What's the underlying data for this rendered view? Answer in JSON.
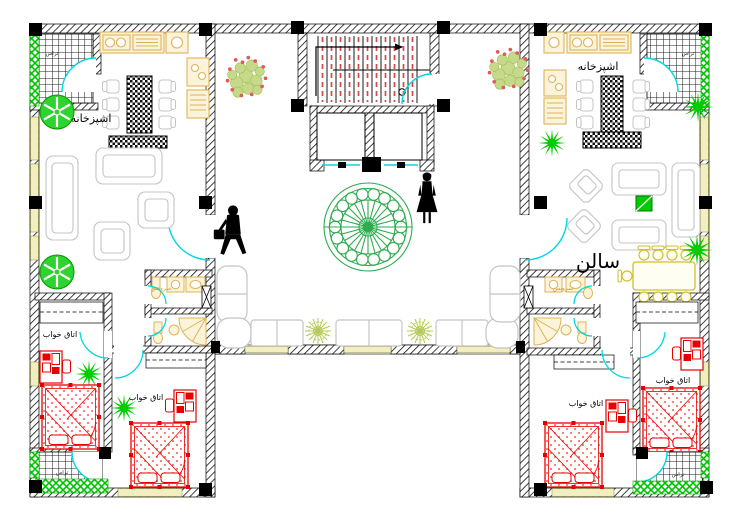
{
  "floor_plan": {
    "type": "residential-apartment-floor-plan",
    "rooms": {
      "kitchen_left": "اشپزخانه",
      "kitchen_right": "اشپزخانه",
      "salon_right": "سالن",
      "wc_left": "سرویس",
      "wc_right": "سرویس",
      "bedroom_left_1": "اتاق خواب",
      "bedroom_left_2": "اتاق خواب",
      "bedroom_right_1": "اتاق خواب",
      "bedroom_right_2": "اتاق خواب",
      "terrace_top_left": "تراس",
      "terrace_top_right": "تراس",
      "terrace_bottom_left": "تراس",
      "terrace_bottom_right": "تراس"
    },
    "colors": {
      "wall": "#000000",
      "door_arc": "#00d8e0",
      "bed_red": "#e80000",
      "tree_green": "#2fd32f",
      "hedge_green": "#00c400",
      "spiky_plant_green": "#00cc00",
      "counter_tan": "#ddb258",
      "dining_yellow": "#d2c028",
      "window_sill": "#f3eec0",
      "furniture_gray": "#c4c4c4",
      "courtyard_ornament_green": "#2eab4f",
      "lobby_plant_olive": "#b4ca55",
      "stair_dash_red": "#d84848",
      "bush_olive": "#c6d98b",
      "bush_berry_red": "#e05a5a"
    }
  }
}
